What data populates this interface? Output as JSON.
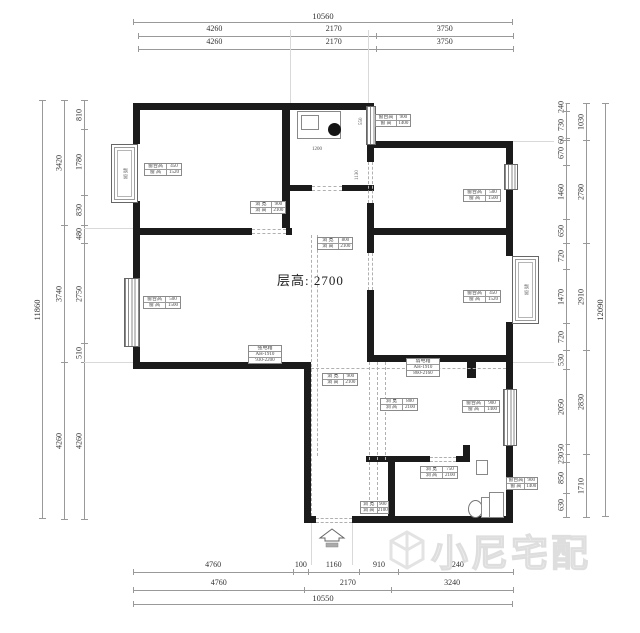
{
  "dims": {
    "top": {
      "total": "10560",
      "row2": [
        "4260",
        "2170",
        "3750"
      ],
      "row3": [
        "4260",
        "2170",
        "3750"
      ]
    },
    "bottom": {
      "row1": [
        "4760",
        "100",
        "1160",
        "910",
        "3240"
      ],
      "row2": [
        "4760",
        "2170",
        "3240"
      ],
      "total": "10550"
    },
    "left": {
      "total": "11860",
      "mid": [
        "3420",
        "3740",
        "4260"
      ],
      "inner": [
        "810",
        "1780",
        "830",
        "480",
        "2750",
        "510",
        "4260"
      ]
    },
    "right": {
      "inner": [
        "240",
        "730",
        "60",
        "670",
        "1460",
        "650",
        "720",
        "1470",
        "720",
        "530",
        "2050",
        "250",
        "230",
        "850",
        "630"
      ],
      "mid": [
        "1030",
        "2780",
        "2910",
        "2830",
        "1710"
      ],
      "total": "12090"
    }
  },
  "plan": {
    "floor_height": "层高: 2700",
    "bay_label": "飘窗",
    "interior_dims": {
      "k1": "1200",
      "k2": "550",
      "k3": "1130"
    }
  },
  "labels": {
    "b1": [
      [
        "窗台高",
        "450"
      ],
      [
        "窗 高",
        "1520"
      ]
    ],
    "b2": [
      [
        "窗台高",
        "900"
      ],
      [
        "窗 高",
        "1400"
      ]
    ],
    "b3": [
      [
        "窗台高",
        "500"
      ],
      [
        "窗 高",
        "1500"
      ]
    ],
    "b4": [
      [
        "洞 宽",
        "900"
      ],
      [
        "洞 高",
        "2100"
      ]
    ],
    "b5": [
      [
        "洞 宽",
        "800"
      ],
      [
        "洞 高",
        "2100"
      ]
    ],
    "b6": [
      [
        "窗台高",
        "500"
      ],
      [
        "窗 高",
        "1500"
      ]
    ],
    "b7": [
      [
        "窗台高",
        "450"
      ],
      [
        "窗 高",
        "1520"
      ]
    ],
    "b8": [
      "强电箱",
      "AH-1910",
      "930-2200"
    ],
    "b9": [
      "弱电箱",
      "AH-1910",
      "860-2160"
    ],
    "b10": [
      [
        "洞 宽",
        "900"
      ],
      [
        "洞 高",
        "2100"
      ]
    ],
    "b11": [
      [
        "洞 宽",
        "800"
      ],
      [
        "洞 高",
        "2100"
      ]
    ],
    "b12": [
      [
        "窗台高",
        "900"
      ],
      [
        "窗 高",
        "1400"
      ]
    ],
    "b14": [
      [
        "洞 宽",
        "750"
      ],
      [
        "洞 高",
        "2100"
      ]
    ],
    "b15": [
      [
        "洞 宽",
        "900"
      ],
      [
        "洞 高",
        "2100"
      ]
    ],
    "b16": [
      [
        "窗台高",
        "900"
      ],
      [
        "窗 高",
        "1400"
      ]
    ]
  },
  "watermark": {
    "text": "小尼宅配"
  }
}
